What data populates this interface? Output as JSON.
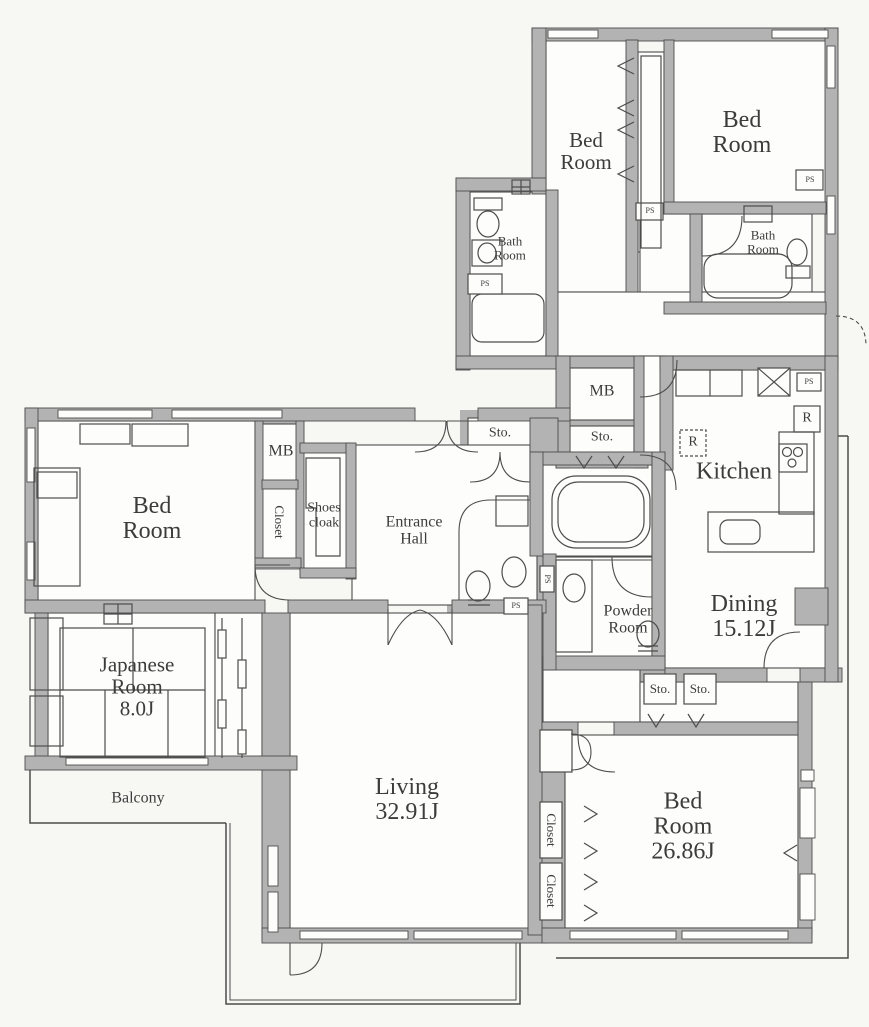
{
  "document": {
    "type": "apartment-floor-plan"
  },
  "rooms": {
    "bedroom_top_left": "Bed\nRoom",
    "bedroom_top_right": "Bed\nRoom",
    "bathroom_left": "Bath\nRoom",
    "bathroom_right": "Bath\nRoom",
    "kitchen": "Kitchen",
    "dining": "Dining\n15.12J",
    "powder_room": "Powder\nRoom",
    "entrance_hall": "Entrance\nHall",
    "shoes_cloak": "Shoes\ncloak",
    "bedroom_west": "Bed\nRoom",
    "japanese_room": "Japanese\nRoom\n8.0J",
    "living": "Living\n32.91J",
    "bedroom_main": "Bed\nRoom\n26.86J",
    "balcony": "Balcony"
  },
  "labels": {
    "mb": "MB",
    "sto": "Sto.",
    "ps": "PS",
    "r": "R",
    "closet": "Closet"
  },
  "areas": {
    "dining": "15.12J",
    "japanese_room": "8.0J",
    "living": "32.91J",
    "bedroom_main": "26.86J"
  },
  "colors": {
    "wall": "#b3b3b3",
    "line": "#4d4d4d",
    "text": "#3c3c3c",
    "paper": "#f7f7f4",
    "room": "#fdfdfb"
  }
}
